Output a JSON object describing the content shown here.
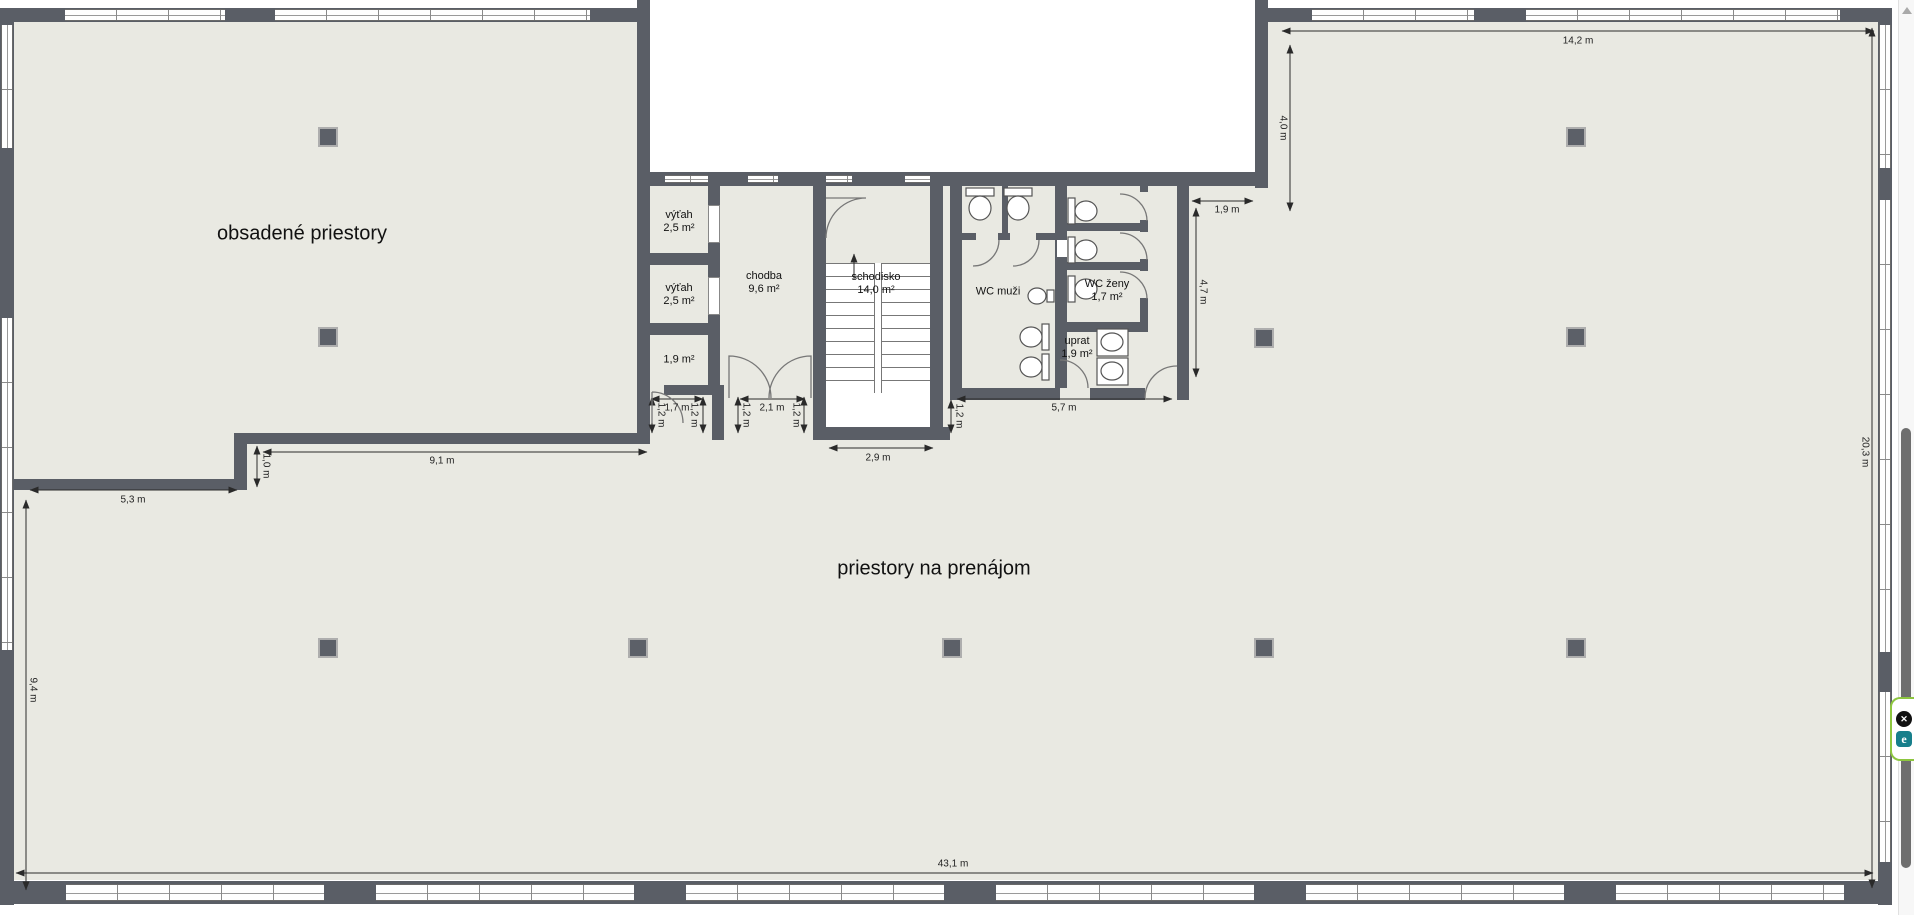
{
  "floorplan": {
    "areas": {
      "occupied": "obsadené priestory",
      "for_rent": "priestory na prenájom"
    },
    "rooms": [
      {
        "name": "výťah",
        "area": "2,5 m²"
      },
      {
        "name": "výťah",
        "area": "2,5 m²"
      },
      {
        "name": "",
        "area": "1,9 m²"
      },
      {
        "name": "chodba",
        "area": "9,6 m²"
      },
      {
        "name": "schodisko",
        "area": "14,0 m²"
      },
      {
        "name": "WC muži",
        "area": ""
      },
      {
        "name": "WC ženy",
        "area": "1,7 m²"
      },
      {
        "name": "uprat",
        "area": "1,9 m²"
      }
    ],
    "dimensions": {
      "top_room_width": "14,2 m",
      "top_room_depth": "4,0 m",
      "wc_side_gap": "1,9 m",
      "wc_block_depth": "4,7 m",
      "wc_block_width": "5,7 m",
      "stair_landing_width": "2,9 m",
      "lift_lobby_door": "1,7 m",
      "corridor_door": "2,1 m",
      "occupied_bottom": "9,1 m",
      "boundary_step": "1,0 m",
      "occupied_left_bottom": "5,3 m",
      "left_side_lower": "9,4 m",
      "right_side": "20,3 m",
      "building_width": "43,1 m",
      "offsets": [
        "1,2 m",
        "1,2 m",
        "1,2 m",
        "1,2 m",
        "1,2 m"
      ]
    },
    "colors": {
      "wall": "#5a5e66",
      "floor": "#e9e9e2",
      "outside": "#ffffff",
      "dimension_text": "#222222"
    }
  },
  "overlay_widget": {
    "close_glyph": "✕",
    "logo_glyph": "e",
    "border_color": "#8dc63f",
    "logo_bg": "#177f8b"
  }
}
